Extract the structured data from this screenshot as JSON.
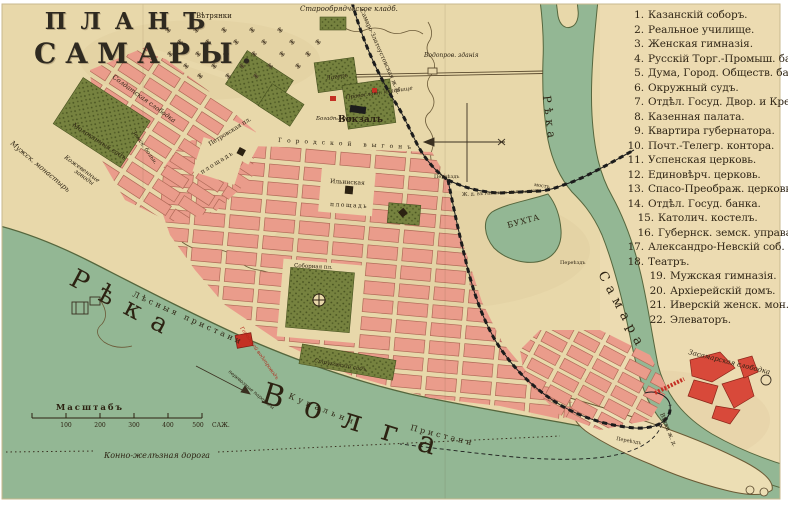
{
  "title": {
    "line1": "ПЛАНЪ",
    "line2": "САМАРЫ."
  },
  "legend": {
    "items": [
      {
        "num": "1.",
        "label": "Казанскій соборъ."
      },
      {
        "num": "2.",
        "label": "Реальное училище."
      },
      {
        "num": "3.",
        "label": "Женская гимназія."
      },
      {
        "num": "4.",
        "label": "Русскій Торг.-Промыш. банкъ."
      },
      {
        "num": "5.",
        "label": "Дума, Город. Обществ. банкъ."
      },
      {
        "num": "6.",
        "label": "Окружный судъ."
      },
      {
        "num": "7.",
        "label": "Отдѣл. Госуд. Двор. и Крест. банк."
      },
      {
        "num": "8.",
        "label": "Казенная палата."
      },
      {
        "num": "9.",
        "label": "Квартира губернатора."
      },
      {
        "num": "10.",
        "label": "Почт.-Телегр. контора."
      },
      {
        "num": "11.",
        "label": "Успенская церковь."
      },
      {
        "num": "12.",
        "label": "Единовѣрч. церковь."
      },
      {
        "num": "13.",
        "label": "Спасо-Преображ. церковь."
      },
      {
        "num": "14.",
        "label": "Отдѣл. Госуд. банка."
      },
      {
        "num": "15.",
        "label": "Католич. костелъ."
      },
      {
        "num": "16.",
        "label": "Губернск. земск. управа."
      },
      {
        "num": "17.",
        "label": "Александро-Невскій соб."
      },
      {
        "num": "18.",
        "label": "Театръ."
      },
      {
        "num": "19.",
        "label": "Мужская гимназія."
      },
      {
        "num": "20.",
        "label": "Архіерейскій домъ."
      },
      {
        "num": "21.",
        "label": "Иверскій женск. мон."
      },
      {
        "num": "22.",
        "label": "Элеваторъ."
      }
    ]
  },
  "map_labels": {
    "vetryanki": "Вѣтрянки",
    "staroobryad": "Старообрядческое кладб.",
    "zhd_main": "Самаро-Златоустовская ж. д.",
    "vodoprov": "Водопров. зданія",
    "lager": "Лагерь",
    "pravosl_kladb": "Православн. кладбище",
    "bogadelnya": "Богадѣльня",
    "vokzal": "Вокзалъ",
    "gorodskoy_vygon": "Городской выгонъ",
    "soldatskaya": "Солдатская слободка",
    "petrovskaya": "Петровская пл.",
    "ploshchad": "площадь",
    "ilinskaya": "Ильинская",
    "sobornaya": "Соборная пл.",
    "molokanny_sad": "Молоканный садъ",
    "muzhskoy_monastyr": "Мужск. монастырь",
    "kozhevennye_1": "Кожевенные",
    "kozhevennye_2": "заводы",
    "zemskaya_bolnitsa": "Земск. больн.",
    "lesnye_pristani": "Лѣсныя пристани",
    "reka": "Рѣка",
    "volga": "Волга",
    "kupalni": "Купальни",
    "pristani": "Пристани",
    "perevoznye": "перевозные пароходы",
    "gorodskoy_vodoprovod": "Городской водопроводъ",
    "strukovskiy_sad": "Струковскій садъ",
    "buhta": "БУХТА",
    "most": "мостъ",
    "zhd_gavan": "Ж. д. въ гавань и мал. затонъ",
    "pereezd": "Переѣздъ",
    "vetka_zhd": "Вѣтка ж. д.",
    "samara": "Самара",
    "zasamarskaya": "Засамарская слободка",
    "konka": "Конно-желѣзная дорога"
  },
  "scale": {
    "title": "Масштабъ",
    "ticks": [
      "100",
      "200",
      "300",
      "400",
      "500"
    ],
    "unit": "САЖ."
  },
  "colors": {
    "paper": "#e8d8aa",
    "river": "#93b794",
    "block": "#ea9c8b",
    "park": "#76823f",
    "rail": "#1c1c1c",
    "red_building": "#c43024",
    "ink": "#2c2212"
  }
}
